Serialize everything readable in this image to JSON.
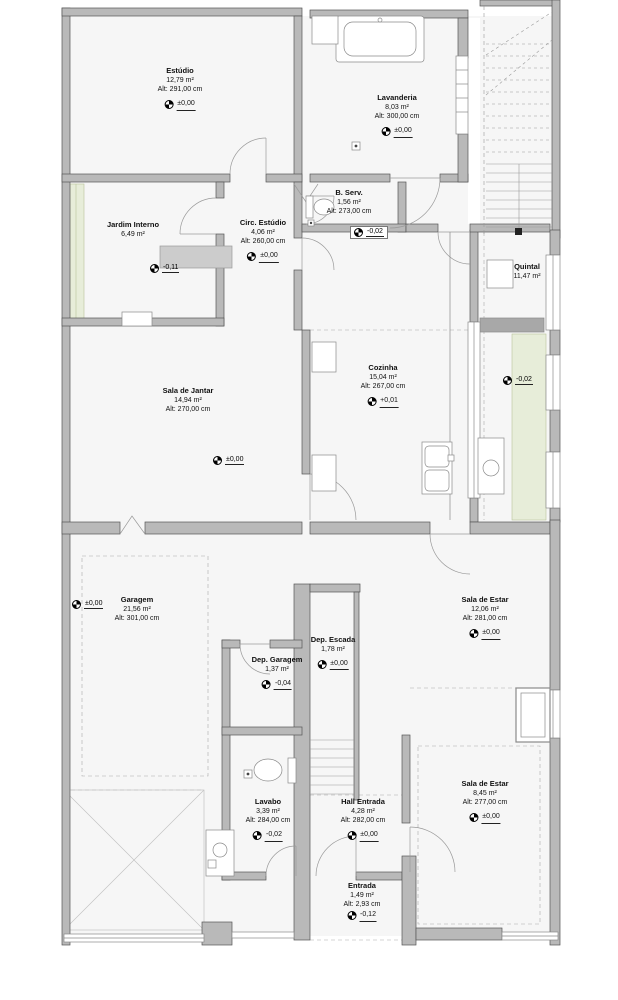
{
  "plan_type": "architectural-floor-plan",
  "colors": {
    "wall_fill": "#b9b9b9",
    "wall_line": "#555555",
    "floor": "#f6f6f6",
    "garden": "#e7edd9",
    "dashed_guide": "#aaaaaa"
  },
  "rooms": [
    {
      "name": "Estúdio",
      "area": "12,79 m²",
      "alt": "Alt: 291,00 cm",
      "level": "±0,00"
    },
    {
      "name": "Lavanderia",
      "area": "8,03 m²",
      "alt": "Alt: 300,00 cm",
      "level": "±0,00"
    },
    {
      "name": "Jardim Interno",
      "area": "6,49 m²",
      "alt": "",
      "level": "-0,11"
    },
    {
      "name": "Circ. Estúdio",
      "area": "4,06 m²",
      "alt": "Alt: 260,00 cm",
      "level": "±0,00"
    },
    {
      "name": "B. Serv.",
      "area": "1,56 m²",
      "alt": "Alt: 273,00 cm",
      "level": "-0,02"
    },
    {
      "name": "Quintal",
      "area": "11,47 m²",
      "alt": "",
      "level": "-0,02"
    },
    {
      "name": "Cozinha",
      "area": "15,04 m²",
      "alt": "Alt: 267,00 cm",
      "level": "+0,01"
    },
    {
      "name": "Sala de Jantar",
      "area": "14,94 m²",
      "alt": "Alt: 270,00 cm",
      "level": "±0,00"
    },
    {
      "name": "Garagem",
      "area": "21,56 m²",
      "alt": "Alt: 301,00 cm",
      "level": "±0,00"
    },
    {
      "name": "Sala de Estar",
      "area": "12,06 m²",
      "alt": "Alt: 281,00 cm",
      "level": "±0,00"
    },
    {
      "name": "Dep. Escada",
      "area": "1,78 m²",
      "alt": "",
      "level": "±0,00"
    },
    {
      "name": "Dep. Garagem",
      "area": "1,37 m²",
      "alt": "",
      "level": "-0,04"
    },
    {
      "name": "Sala de Estar",
      "area": "8,45 m²",
      "alt": "Alt: 277,00 cm",
      "level": "±0,00"
    },
    {
      "name": "Lavabo",
      "area": "3,39 m²",
      "alt": "Alt: 284,00 cm",
      "level": "-0,02"
    },
    {
      "name": "Hall Entrada",
      "area": "4,28 m²",
      "alt": "Alt: 282,00 cm",
      "level": "±0,00"
    },
    {
      "name": "Entrada",
      "area": "1,49 m²",
      "alt": "Alt: 2,93 cm",
      "level": "-0,12"
    }
  ]
}
